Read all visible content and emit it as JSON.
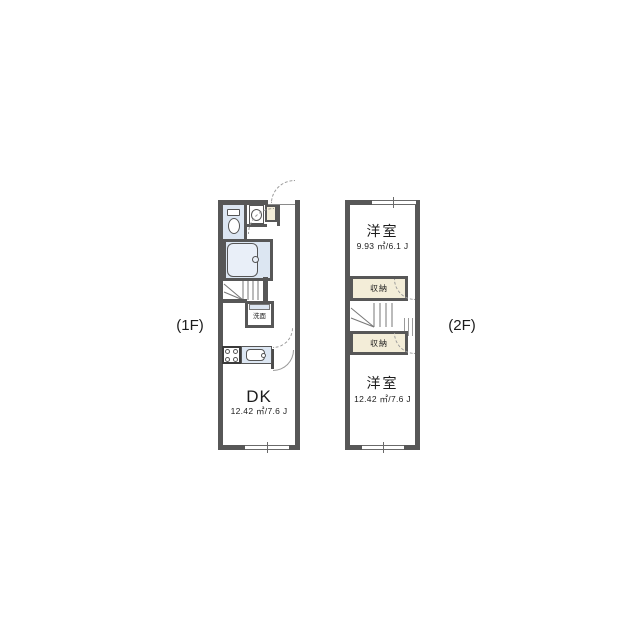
{
  "title": "two-story apartment floor plan",
  "floors": [
    {
      "label": "(1F)",
      "dk": {
        "name": "DK",
        "area": "12.42 ㎡/7.6 J"
      },
      "washroom": {
        "name": "洗面"
      },
      "fixture_names": [
        "toilet-fixture",
        "washbasin-fixture",
        "shoe-cabinet",
        "bathtub-fixture",
        "staircase",
        "stove-fixture",
        "kitchen-sink-fixture",
        "washstand-fixture"
      ]
    },
    {
      "label": "(2F)",
      "bedroom_top": {
        "name": "洋室",
        "area": "9.93 ㎡/6.1 J"
      },
      "closet_top": {
        "name": "収納"
      },
      "closet_bottom": {
        "name": "収納"
      },
      "bedroom_bottom": {
        "name": "洋室",
        "area": "12.42 ㎡/7.6 J"
      },
      "fixture_names": [
        "staircase",
        "stair-railing"
      ]
    }
  ],
  "colors": {
    "wall": "#575757",
    "water_area": "#dce6f2",
    "closet_fill": "#f3edd8",
    "tub_fill": "#e9eff8",
    "line": "#9a9a9a"
  }
}
